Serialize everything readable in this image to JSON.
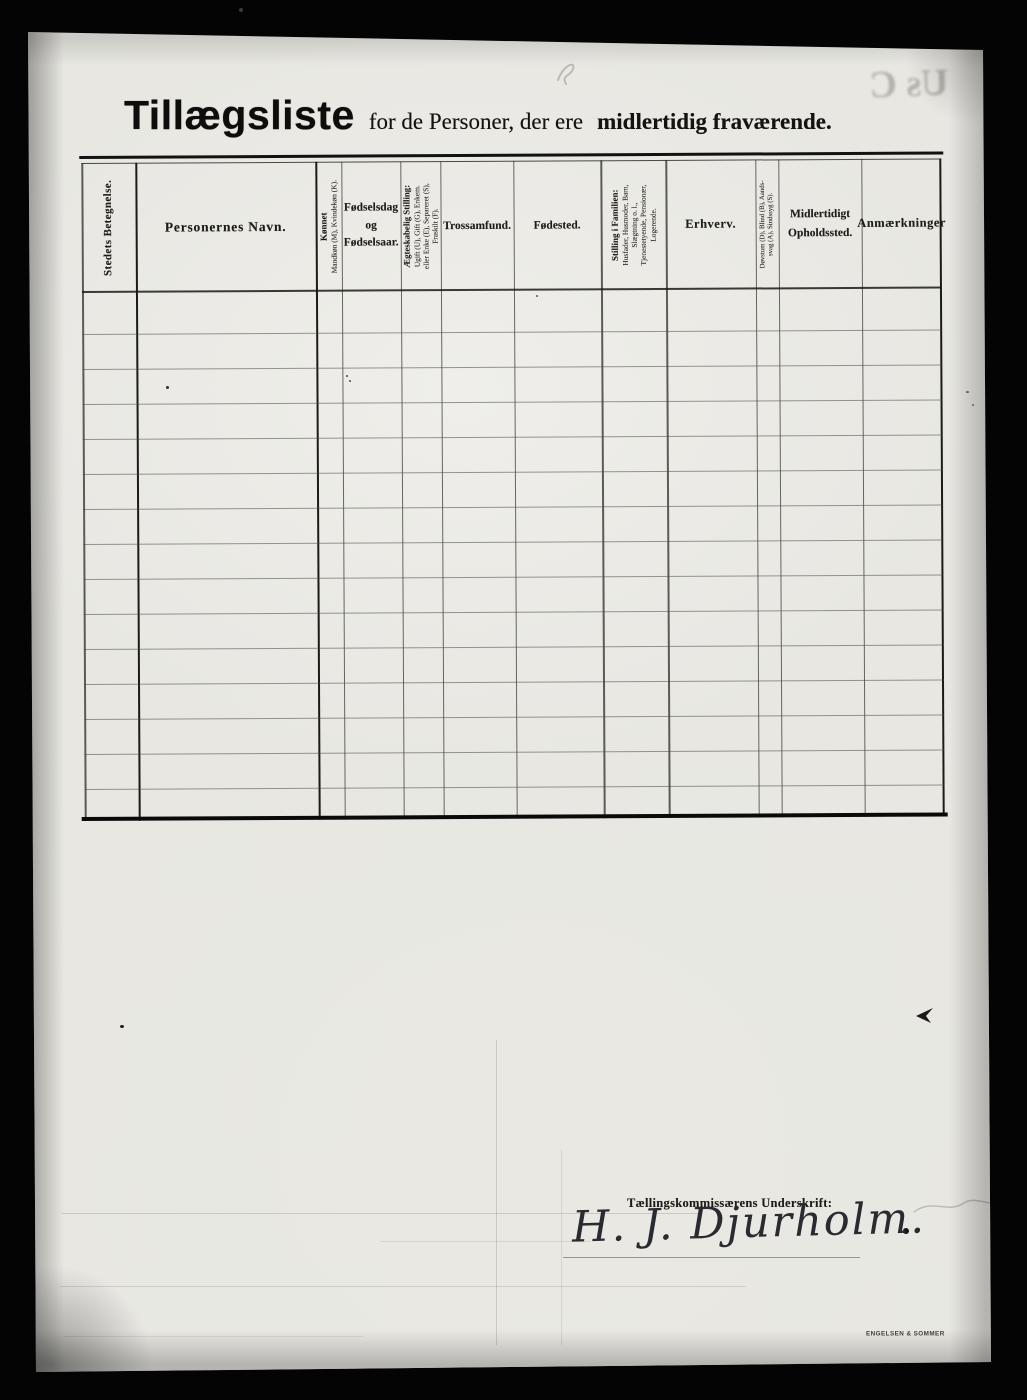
{
  "document": {
    "title": {
      "main": "Tillægsliste",
      "connector": "for de Personer, der ere",
      "emphasis": "midlertidig fraværende."
    }
  },
  "table": {
    "row_count": 15,
    "columns": [
      {
        "key": "stedets-betegnelse",
        "orientation": "vertical",
        "title": "Stedets Betegnelse."
      },
      {
        "key": "personernes-navn",
        "orientation": "horizontal",
        "title": "Personernes Navn."
      },
      {
        "key": "koennet",
        "orientation": "vertical",
        "title": "Kønnet",
        "sub": "Mandkøn (M), Kvindekøn (K)."
      },
      {
        "key": "foedselsdag",
        "orientation": "horizontal",
        "title": "Fødselsdag\nog\nFødselsaar."
      },
      {
        "key": "aegteskabelig-stilling",
        "orientation": "vertical",
        "title": "Ægteskabelig Stilling:",
        "sub": "Ugift (U), Gift (G), Enkem.\neller Enke (E), Separeret (S),\nFraskilt (F)."
      },
      {
        "key": "trossamfund",
        "orientation": "horizontal",
        "title": "Trossamfund."
      },
      {
        "key": "foedested",
        "orientation": "horizontal",
        "title": "Fødested."
      },
      {
        "key": "stilling-i-familien",
        "orientation": "vertical",
        "title": "Stilling i Familien:",
        "sub": "Husfader, Husmoder, Barn,\nSlægtning o. l.,\nTjenestetyende, Pensionær,\nLogerende."
      },
      {
        "key": "erhverv",
        "orientation": "horizontal",
        "title": "Erhverv."
      },
      {
        "key": "doevstum",
        "orientation": "vertical",
        "sub": "Døvstum (D), Blind (B), Aands-\nsvag (A), Sindssyg (S)."
      },
      {
        "key": "midlertidigt-opholdssted",
        "orientation": "horizontal",
        "title": "Midlertidigt\nOpholdssted."
      },
      {
        "key": "anmaerkninger",
        "orientation": "horizontal",
        "title": "Anmærkninger"
      }
    ]
  },
  "signature": {
    "label": "Tællingskommissærens Underskrift:",
    "name": "H. J. Djurholm."
  },
  "marginalia": {
    "printer_imprint": "ENGELSEN & SOMMER",
    "bleed_through_text": "Us C"
  },
  "colors": {
    "scan_background": "#040404",
    "paper": "#e8e7e2",
    "ink": "#14130f",
    "rule_gray": "#4a4840"
  }
}
